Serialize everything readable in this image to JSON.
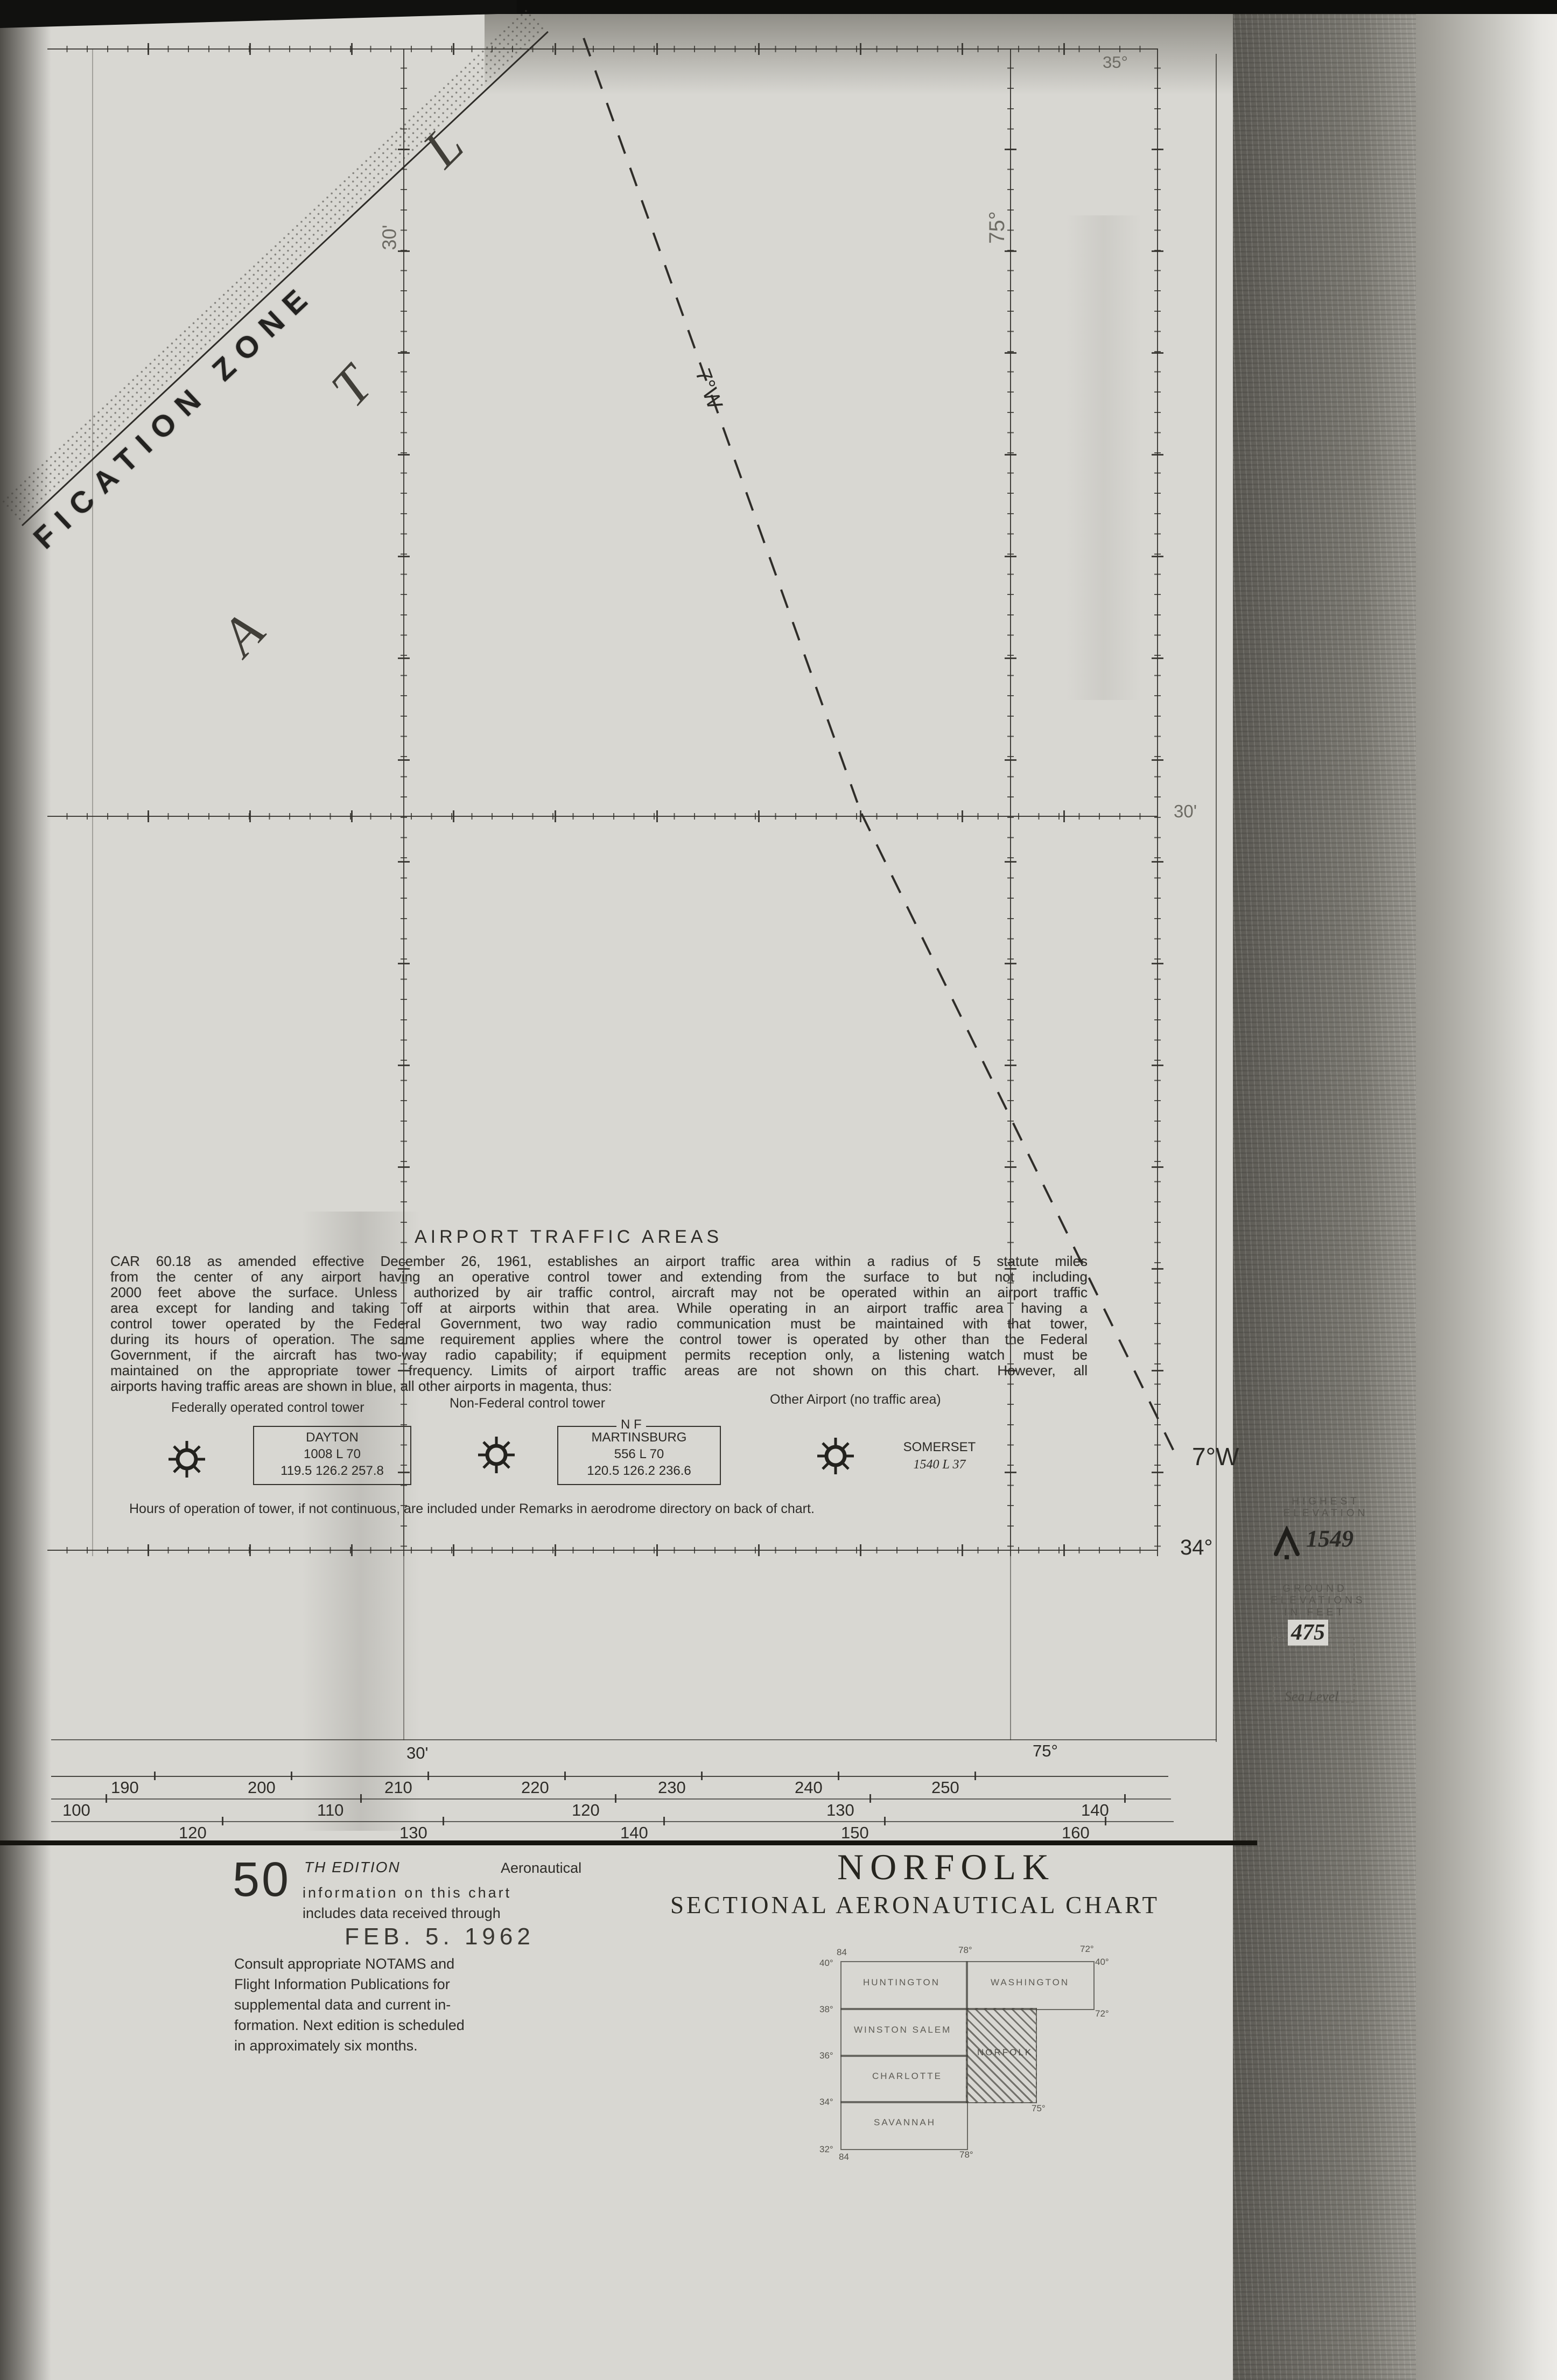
{
  "map": {
    "adiz_text": "FICATION ZONE",
    "ocean_letters": {
      "a": "A",
      "t": "T",
      "l": "L"
    },
    "isogonic_label_mid": "7°W",
    "isogonic_label_end": "7°W",
    "lat_top_right": "35°",
    "lat_bottom_right": "34°",
    "parallel_label_right": "30'",
    "meridian_label_30": "30'",
    "meridian_label_75": "75°",
    "bottom_lon_30": "30'",
    "bottom_lon_75": "75°"
  },
  "traffic": {
    "title": "AIRPORT TRAFFIC AREAS",
    "body_lines": [
      "CAR 60.18 as amended effective December 26, 1961, establishes an airport traffic area within a radius of 5 statute miles",
      "from the center of any airport having an operative control tower and extending from the surface to but not including",
      "2000 feet above the surface. Unless authorized by air traffic control, aircraft may not be operated within an airport traffic",
      "area except for landing and taking off at airports within that area. While operating in an airport traffic area having a",
      "control tower operated by the Federal Government, two way radio communication must be maintained with that tower,",
      "during its hours of operation. The same requirement applies where the control tower is operated by other than the Federal",
      "Government, if the aircraft has two-way radio capability; if equipment permits reception only, a listening watch must be",
      "maintained on the appropriate tower frequency. Limits of airport traffic areas are not shown on this chart. However, all",
      "airports having traffic areas are shown in blue, all other airports in magenta, thus:"
    ],
    "legend": {
      "federal_header": "Federally operated control tower",
      "nonfederal_header": "Non-Federal control tower",
      "other_header": "Other Airport (no traffic area)",
      "nf_tag": "N F",
      "dayton": {
        "name": "DAYTON",
        "line2": "1008 L 70",
        "line3": "119.5 126.2 257.8"
      },
      "martinsburg": {
        "name": "MARTINSBURG",
        "line2": "556 L 70",
        "line3": "120.5 126.2 236.6"
      },
      "somerset": {
        "name": "SOMERSET",
        "line2": "1540 L 37"
      }
    },
    "hours_note": "Hours of operation of tower, if not continuous, are included under Remarks in aerodrome directory on back of chart."
  },
  "elevation_panel": {
    "highest_1": "HIGHEST",
    "highest_2": "ELEVATION",
    "highest_value": "1549",
    "ground_1": "GROUND",
    "ground_2": "ELEVATIONS",
    "ground_3": "IN FEET",
    "ground_value": "475",
    "sea_level": "Sea Level"
  },
  "scales": {
    "rows": [
      {
        "labels": [
          "190",
          "200",
          "210",
          "220",
          "230",
          "240",
          "250"
        ]
      },
      {
        "labels": [
          "100",
          "110",
          "120",
          "130",
          "140"
        ]
      },
      {
        "labels": [
          "120",
          "130",
          "140",
          "150",
          "160"
        ]
      }
    ]
  },
  "edition": {
    "number": "50",
    "suffix": "TH EDITION",
    "intro_right": "Aeronautical",
    "line2": "information on this chart",
    "line3": "includes data received through",
    "date": "FEB. 5. 1962",
    "consult_lines": [
      "Consult appropriate NOTAMS and",
      "Flight Information Publications for",
      "supplemental data and current in-",
      "formation. Next edition is scheduled",
      "in approximately six months."
    ]
  },
  "title_block": {
    "title": "NORFOLK",
    "subtitle": "SECTIONAL AERONAUTICAL CHART"
  },
  "index_map": {
    "cells": {
      "huntington": "HUNTINGTON",
      "washington": "WASHINGTON",
      "winston_salem": "WINSTON SALEM",
      "norfolk": "NORFOLK",
      "charlotte": "CHARLOTTE",
      "savannah": "SAVANNAH"
    },
    "coords": {
      "top_84": "84",
      "top_78": "78°",
      "top_72": "72°",
      "left_40": "40°",
      "right_40": "40°",
      "left_38": "38°",
      "right_72": "72°",
      "left_36": "36°",
      "left_34": "34°",
      "mid_75": "75°",
      "left_32": "32°",
      "bottom_84": "84",
      "bottom_78": "78°"
    }
  }
}
